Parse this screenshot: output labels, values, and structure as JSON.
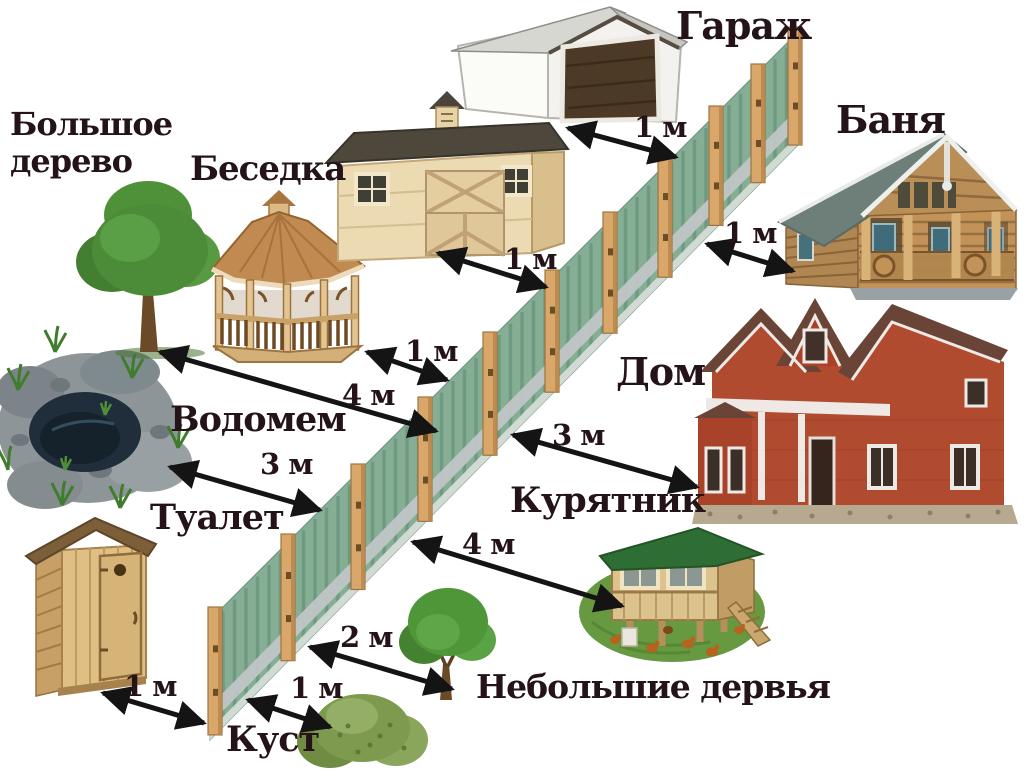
{
  "labels": {
    "garage": "Гараж",
    "banya": "Баня",
    "big_tree_line1": "Большое",
    "big_tree_line2": "дерево",
    "gazebo": "Беседка",
    "house": "Дом",
    "pond": "Водомем",
    "toilet": "Туалет",
    "chicken_coop": "Курятник",
    "small_trees": "Небольшие дервья",
    "bush": "Куст"
  },
  "distances": {
    "garage_to_fence": "1 м",
    "shed_to_fence": "1 м",
    "banya_to_fence": "1 м",
    "gazebo_to_fence": "1 м",
    "big_tree_to_fence": "4 м",
    "pond_to_fence": "3 м",
    "house_to_fence": "3 м",
    "chicken_coop_to_fence": "4 м",
    "small_trees_to_fence": "2 м",
    "bush_to_fence": "1 м",
    "toilet_to_fence": "1 м"
  },
  "colors": {
    "background": "#ffffff",
    "text": "#241318",
    "arrow": "#141414",
    "fence_picket": "#86ae95",
    "fence_picket_shade": "#5e8a74",
    "fence_post": "#daa76a",
    "fence_rail": "#c2c7c8"
  }
}
